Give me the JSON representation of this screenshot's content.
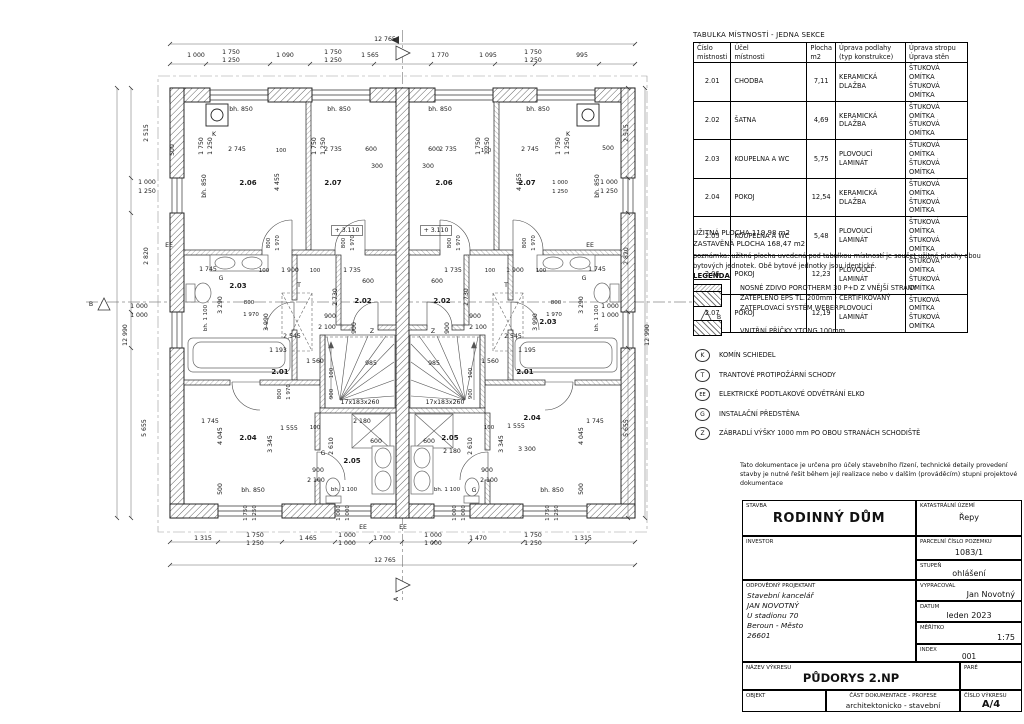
{
  "table": {
    "title": "TABULKA MÍSTNOSTÍ - JEDNA SEKCE",
    "headers": [
      "Číslo\nmístnosti",
      "Účel\nmístnosti",
      "Plocha\nm2",
      "Úprava podlahy\n(typ konstrukce)",
      "Úprava stropu\nÚprava stěn"
    ],
    "rows": [
      {
        "no": "2.01",
        "name": "CHODBA",
        "area": "7,11",
        "floor": "KERAMICKÁ DLAŽBA",
        "fin": "ŠTUKOVÁ OMÍTKA\nŠTUKOVÁ OMÍTKA"
      },
      {
        "no": "2.02",
        "name": "ŠATNA",
        "area": "4,69",
        "floor": "KERAMICKÁ DLAŽBA",
        "fin": "ŠTUKOVÁ OMÍTKA\nŠTUKOVÁ OMÍTKA"
      },
      {
        "no": "2.03",
        "name": "KOUPELNA A WC",
        "area": "5,75",
        "floor": "PLOVOUCÍ LAMINÁT",
        "fin": "ŠTUKOVÁ OMÍTKA\nŠTUKOVÁ OMÍTKA"
      },
      {
        "no": "2.04",
        "name": "POKOJ",
        "area": "12,54",
        "floor": "KERAMICKÁ DLAŽBA",
        "fin": "ŠTUKOVÁ OMÍTKA\nŠTUKOVÁ OMÍTKA"
      },
      {
        "no": "2.05",
        "name": "KOUPELNA A WC",
        "area": "5,48",
        "floor": "PLOVOUCÍ LAMINÁT",
        "fin": "ŠTUKOVÁ OMÍTKA\nŠTUKOVÁ OMÍTKA"
      },
      {
        "no": "2.06",
        "name": "POKOJ",
        "area": "12,23",
        "floor": "PLOVOUCÍ LAMINÁT",
        "fin": "ŠTUKOVÁ OMÍTKA\nŠTUKOVÁ OMÍTKA"
      },
      {
        "no": "2.07",
        "name": "POKOJ",
        "area": "12,19",
        "floor": "PLOVOUCÍ LAMINÁT",
        "fin": "ŠTUKOVÁ OMÍTKA\nŠTUKOVÁ OMÍTKA"
      }
    ]
  },
  "summary": {
    "usable": "UŽITNÁ PLOCHA 119,98 m2",
    "built": "ZASTAVĚNÁ PLOCHA 168,47 m2"
  },
  "note": "poznámka: užitná plocha uvedená pod tabulkou místností je součet užitné plochy obou bytových jednotek. Obě bytové jednotky jsou identické.",
  "legend": {
    "title": "LEGENDA",
    "wall1": "NOSNÉ ZDIVO POROTHERM 30 P+D Z VNĚJŠÍ STRANY\nZATEPLENO EPS TL. 200mm - CERTIFIKOVANÝ\nZATEPLOVACÍ SYSTÉM WEBER",
    "wall2": "VNITŘNÍ PŘÍČKY YTONG 100mm",
    "symbols": [
      {
        "key": "K",
        "text": "KOMÍN SCHIEDEL"
      },
      {
        "key": "T",
        "text": "TRANTOVÉ PROTIPOŽÁRNÍ SCHODY"
      },
      {
        "key": "EE",
        "text": "ELEKTRICKÉ PODTLAKOVÉ ODVĚTRÁNÍ ELKO"
      },
      {
        "key": "G",
        "text": "INSTALAČNÍ PŘEDSTĚNA"
      },
      {
        "key": "Z",
        "text": "ZÁBRADLÍ VÝŠKY 1000 mm PO OBOU STRANÁCH SCHODIŠTĚ"
      }
    ]
  },
  "titleblock": {
    "disclaimer": "Tato dokumentace je určena pro účely stavebního řízení, technické detaily provedení stavby je nutné řešit během její realizace nebo v dalším (prováděcím) stupni projektové dokumentace",
    "stavba_label": "STAVBA",
    "stavba": "RODINNÝ DŮM",
    "ku_label": "KATASTRÁLNÍ ÚZEMÍ",
    "ku": "Řepy",
    "investor_label": "INVESTOR",
    "investor": "",
    "parcela_label": "PARCELNÍ ČÍSLO POZEMKU",
    "parcela": "1083/1",
    "stupen_label": "STUPEŇ",
    "stupen": "ohlášení",
    "projektant_label": "ODPOVĚDNÝ PROJEKTANT",
    "projektant": "Stavební kancelář\nJAN NOVOTNÝ\nU stadionu 70\nBeroun - Město\n26601",
    "vypracoval_label": "VYPRACOVAL",
    "vypracoval": "Jan Novotný",
    "datum_label": "DATUM",
    "datum": "leden 2023",
    "meritko_label": "MĚŘÍTKO",
    "meritko": "1:75",
    "index_label": "INDEX",
    "index": "001",
    "nazev_label": "NÁZEV VÝKRESU",
    "nazev": "PŮDORYS 2.NP",
    "pare_label": "PARÉ",
    "objekt_label": "OBJEKT",
    "cast_label": "ČÁST DOKUMENTACE - PROFESE",
    "cast": "architektonicko - stavební",
    "cislo_label": "ČÍSLO VÝKRESU",
    "cislo": "A/4"
  },
  "plan": {
    "labels": [
      {
        "t": "12 765",
        "x": 385,
        "y": 41
      },
      {
        "t": "1 000",
        "x": 196,
        "y": 57
      },
      {
        "t": "1 750",
        "x": 231,
        "y": 54
      },
      {
        "t": "1 250",
        "x": 231,
        "y": 62
      },
      {
        "t": "1 090",
        "x": 285,
        "y": 57
      },
      {
        "t": "1 750",
        "x": 333,
        "y": 54
      },
      {
        "t": "1 250",
        "x": 333,
        "y": 62
      },
      {
        "t": "1 565",
        "x": 370,
        "y": 57
      },
      {
        "t": "1 770",
        "x": 440,
        "y": 57
      },
      {
        "t": "1 095",
        "x": 488,
        "y": 57
      },
      {
        "t": "1 750",
        "x": 533,
        "y": 54
      },
      {
        "t": "1 250",
        "x": 533,
        "y": 62
      },
      {
        "t": "995",
        "x": 582,
        "y": 57
      },
      {
        "t": "500",
        "x": 174,
        "y": 150,
        "r": 1
      },
      {
        "t": "1 750",
        "x": 203,
        "y": 146,
        "r": 1
      },
      {
        "t": "1 250",
        "x": 212,
        "y": 146,
        "r": 1
      },
      {
        "t": "1 750",
        "x": 316,
        "y": 146,
        "r": 1
      },
      {
        "t": "1 250",
        "x": 325,
        "y": 146,
        "r": 1
      },
      {
        "t": "1 750",
        "x": 480,
        "y": 146,
        "r": 1
      },
      {
        "t": "1 250",
        "x": 489,
        "y": 146,
        "r": 1
      },
      {
        "t": "1 750",
        "x": 560,
        "y": 146,
        "r": 1
      },
      {
        "t": "1 250",
        "x": 569,
        "y": 146,
        "r": 1
      },
      {
        "t": "500",
        "x": 608,
        "y": 150
      },
      {
        "t": "bh. 850",
        "x": 241,
        "y": 111
      },
      {
        "t": "bh. 850",
        "x": 339,
        "y": 111
      },
      {
        "t": "bh. 850",
        "x": 440,
        "y": 111
      },
      {
        "t": "bh. 850",
        "x": 538,
        "y": 111
      },
      {
        "t": "K",
        "x": 214,
        "y": 136
      },
      {
        "t": "K",
        "x": 568,
        "y": 136
      },
      {
        "t": "2 745",
        "x": 237,
        "y": 151
      },
      {
        "t": "100",
        "x": 281,
        "y": 152,
        "s": 5.5
      },
      {
        "t": "2 735",
        "x": 333,
        "y": 151
      },
      {
        "t": "600",
        "x": 371,
        "y": 151
      },
      {
        "t": "300",
        "x": 377,
        "y": 168
      },
      {
        "t": "2 735",
        "x": 448,
        "y": 151
      },
      {
        "t": "100",
        "x": 486,
        "y": 152,
        "s": 5.5
      },
      {
        "t": "2 745",
        "x": 530,
        "y": 151
      },
      {
        "t": "600",
        "x": 434,
        "y": 151
      },
      {
        "t": "300",
        "x": 428,
        "y": 168
      },
      {
        "t": "4 455",
        "x": 279,
        "y": 182,
        "r": 1
      },
      {
        "t": "4 455",
        "x": 521,
        "y": 182,
        "r": 1
      },
      {
        "t": "2.06",
        "x": 248,
        "y": 185,
        "w": 1
      },
      {
        "t": "2.07",
        "x": 333,
        "y": 185,
        "w": 1
      },
      {
        "t": "2.06",
        "x": 444,
        "y": 185,
        "w": 1
      },
      {
        "t": "2.07",
        "x": 527,
        "y": 185,
        "w": 1
      },
      {
        "t": "bh. 850",
        "x": 206,
        "y": 186,
        "r": 1
      },
      {
        "t": "bh. 850",
        "x": 599,
        "y": 186,
        "r": 1
      },
      {
        "t": "+ 3.110",
        "x": 347,
        "y": 232,
        "box": 1
      },
      {
        "t": "+ 3.110",
        "x": 436,
        "y": 232,
        "box": 1
      },
      {
        "t": "800",
        "x": 270,
        "y": 243,
        "r": 1,
        "s": 5.5
      },
      {
        "t": "1 970",
        "x": 279,
        "y": 243,
        "r": 1,
        "s": 5.5
      },
      {
        "t": "800",
        "x": 345,
        "y": 243,
        "r": 1,
        "s": 5.5
      },
      {
        "t": "1 970",
        "x": 354,
        "y": 243,
        "r": 1,
        "s": 5.5
      },
      {
        "t": "800",
        "x": 451,
        "y": 243,
        "r": 1,
        "s": 5.5
      },
      {
        "t": "1 970",
        "x": 460,
        "y": 243,
        "r": 1,
        "s": 5.5
      },
      {
        "t": "800",
        "x": 526,
        "y": 243,
        "r": 1,
        "s": 5.5
      },
      {
        "t": "1 970",
        "x": 535,
        "y": 243,
        "r": 1,
        "s": 5.5
      },
      {
        "t": "2 515",
        "x": 148,
        "y": 133,
        "r": 1
      },
      {
        "t": "2 515",
        "x": 628,
        "y": 133,
        "r": 1
      },
      {
        "t": "1 000",
        "x": 147,
        "y": 184
      },
      {
        "t": "1 250",
        "x": 147,
        "y": 193
      },
      {
        "t": "1 000",
        "x": 609,
        "y": 184
      },
      {
        "t": "1 250",
        "x": 609,
        "y": 193
      },
      {
        "t": "1 000",
        "x": 560,
        "y": 184,
        "s": 5.5
      },
      {
        "t": "1 250",
        "x": 560,
        "y": 193,
        "s": 5.5
      },
      {
        "t": "2 820",
        "x": 148,
        "y": 256,
        "r": 1
      },
      {
        "t": "2 820",
        "x": 628,
        "y": 256,
        "r": 1
      },
      {
        "t": "EE",
        "x": 169,
        "y": 247
      },
      {
        "t": "EE",
        "x": 590,
        "y": 247
      },
      {
        "t": "12 990",
        "x": 127,
        "y": 335,
        "r": 1
      },
      {
        "t": "12 990",
        "x": 649,
        "y": 335,
        "r": 1
      },
      {
        "t": "1 745",
        "x": 208,
        "y": 271
      },
      {
        "t": "100",
        "x": 264,
        "y": 272,
        "s": 5.5
      },
      {
        "t": "1 900",
        "x": 290,
        "y": 272
      },
      {
        "t": "100",
        "x": 315,
        "y": 272,
        "s": 5.5
      },
      {
        "t": "1 735",
        "x": 352,
        "y": 272
      },
      {
        "t": "600",
        "x": 368,
        "y": 283
      },
      {
        "t": "G",
        "x": 221,
        "y": 280
      },
      {
        "t": "T",
        "x": 299,
        "y": 287
      },
      {
        "t": "2.03",
        "x": 238,
        "y": 288,
        "w": 1
      },
      {
        "t": "2.02",
        "x": 363,
        "y": 303,
        "w": 1
      },
      {
        "t": "2 730",
        "x": 337,
        "y": 297,
        "r": 1
      },
      {
        "t": "3 290",
        "x": 222,
        "y": 305,
        "r": 1
      },
      {
        "t": "bh. 1 100",
        "x": 207,
        "y": 318,
        "r": 1,
        "s": 5.5
      },
      {
        "t": "800",
        "x": 249,
        "y": 304,
        "s": 5.5
      },
      {
        "t": "1 970",
        "x": 251,
        "y": 316,
        "s": 5.5
      },
      {
        "t": "3 990",
        "x": 268,
        "y": 322,
        "r": 1
      },
      {
        "t": "900",
        "x": 330,
        "y": 318
      },
      {
        "t": "2 100",
        "x": 327,
        "y": 329
      },
      {
        "t": "900",
        "x": 356,
        "y": 328,
        "r": 1
      },
      {
        "t": "2 545",
        "x": 292,
        "y": 338
      },
      {
        "t": "Z",
        "x": 372,
        "y": 333
      },
      {
        "t": "1 193",
        "x": 278,
        "y": 352
      },
      {
        "t": "1 560",
        "x": 315,
        "y": 363
      },
      {
        "t": "985",
        "x": 371,
        "y": 365
      },
      {
        "t": "100",
        "x": 333,
        "y": 373,
        "r": 1,
        "s": 5.5
      },
      {
        "t": "2.01",
        "x": 280,
        "y": 374,
        "w": 1
      },
      {
        "t": "800",
        "x": 281,
        "y": 394,
        "r": 1,
        "s": 5.5
      },
      {
        "t": "1 970",
        "x": 290,
        "y": 392,
        "r": 1,
        "s": 5.5
      },
      {
        "t": "900",
        "x": 333,
        "y": 394,
        "r": 1,
        "s": 5.5
      },
      {
        "t": "17x183x260",
        "x": 360,
        "y": 404
      },
      {
        "t": "1 745",
        "x": 597,
        "y": 271
      },
      {
        "t": "100",
        "x": 541,
        "y": 272,
        "s": 5.5
      },
      {
        "t": "1 900",
        "x": 515,
        "y": 272
      },
      {
        "t": "100",
        "x": 490,
        "y": 272,
        "s": 5.5
      },
      {
        "t": "1 735",
        "x": 453,
        "y": 272
      },
      {
        "t": "600",
        "x": 437,
        "y": 283
      },
      {
        "t": "G",
        "x": 584,
        "y": 280
      },
      {
        "t": "T",
        "x": 506,
        "y": 287
      },
      {
        "t": "2.03",
        "x": 548,
        "y": 324,
        "w": 1
      },
      {
        "t": "2.02",
        "x": 442,
        "y": 303,
        "w": 1
      },
      {
        "t": "2 730",
        "x": 468,
        "y": 297,
        "r": 1
      },
      {
        "t": "3 290",
        "x": 583,
        "y": 305,
        "r": 1
      },
      {
        "t": "bh. 1 100",
        "x": 598,
        "y": 318,
        "r": 1,
        "s": 5.5
      },
      {
        "t": "800",
        "x": 556,
        "y": 304,
        "s": 5.5
      },
      {
        "t": "1 970",
        "x": 554,
        "y": 316,
        "s": 5.5
      },
      {
        "t": "3 990",
        "x": 537,
        "y": 322,
        "r": 1
      },
      {
        "t": "900",
        "x": 475,
        "y": 318
      },
      {
        "t": "2 100",
        "x": 478,
        "y": 329
      },
      {
        "t": "900",
        "x": 449,
        "y": 328,
        "r": 1
      },
      {
        "t": "2 545",
        "x": 513,
        "y": 338
      },
      {
        "t": "Z",
        "x": 433,
        "y": 333
      },
      {
        "t": "1 195",
        "x": 527,
        "y": 352
      },
      {
        "t": "1 560",
        "x": 490,
        "y": 363
      },
      {
        "t": "985",
        "x": 434,
        "y": 365
      },
      {
        "t": "100",
        "x": 472,
        "y": 373,
        "r": 1,
        "s": 5.5
      },
      {
        "t": "2.01",
        "x": 525,
        "y": 374,
        "w": 1
      },
      {
        "t": "900",
        "x": 472,
        "y": 394,
        "r": 1,
        "s": 5.5
      },
      {
        "t": "17x183x260",
        "x": 445,
        "y": 404
      },
      {
        "t": "1 745",
        "x": 210,
        "y": 423
      },
      {
        "t": "4 045",
        "x": 222,
        "y": 436,
        "r": 1
      },
      {
        "t": "2.04",
        "x": 248,
        "y": 440,
        "w": 1
      },
      {
        "t": "3 345",
        "x": 272,
        "y": 444,
        "r": 1
      },
      {
        "t": "1 555",
        "x": 289,
        "y": 430
      },
      {
        "t": "100",
        "x": 315,
        "y": 429,
        "s": 5.5
      },
      {
        "t": "2 610",
        "x": 333,
        "y": 446,
        "r": 1
      },
      {
        "t": "2 180",
        "x": 362,
        "y": 423
      },
      {
        "t": "600",
        "x": 376,
        "y": 443
      },
      {
        "t": "G",
        "x": 323,
        "y": 455
      },
      {
        "t": "2.05",
        "x": 352,
        "y": 463,
        "w": 1
      },
      {
        "t": "900",
        "x": 318,
        "y": 472
      },
      {
        "t": "2 100",
        "x": 316,
        "y": 482
      },
      {
        "t": "bh. 850",
        "x": 253,
        "y": 492
      },
      {
        "t": "bh. 1 100",
        "x": 344,
        "y": 491,
        "s": 5.5
      },
      {
        "t": "500",
        "x": 222,
        "y": 489,
        "r": 1
      },
      {
        "t": "1 745",
        "x": 595,
        "y": 423
      },
      {
        "t": "4 045",
        "x": 583,
        "y": 436,
        "r": 1
      },
      {
        "t": "2.04",
        "x": 532,
        "y": 420,
        "w": 1
      },
      {
        "t": "3 345",
        "x": 503,
        "y": 444,
        "r": 1
      },
      {
        "t": "1 555",
        "x": 516,
        "y": 428
      },
      {
        "t": "100",
        "x": 489,
        "y": 429,
        "s": 5.5
      },
      {
        "t": "2 610",
        "x": 472,
        "y": 446,
        "r": 1
      },
      {
        "t": "2 180",
        "x": 452,
        "y": 453
      },
      {
        "t": "600",
        "x": 429,
        "y": 443
      },
      {
        "t": "3 300",
        "x": 527,
        "y": 451
      },
      {
        "t": "G",
        "x": 474,
        "y": 492
      },
      {
        "t": "2.05",
        "x": 450,
        "y": 440,
        "w": 1
      },
      {
        "t": "900",
        "x": 487,
        "y": 472
      },
      {
        "t": "2 100",
        "x": 489,
        "y": 482
      },
      {
        "t": "bh. 850",
        "x": 552,
        "y": 492
      },
      {
        "t": "bh. 1 100",
        "x": 447,
        "y": 491,
        "s": 5.5
      },
      {
        "t": "500",
        "x": 583,
        "y": 489,
        "r": 1
      },
      {
        "t": "1 000",
        "x": 139,
        "y": 308
      },
      {
        "t": "1 000",
        "x": 139,
        "y": 317
      },
      {
        "t": "1 000",
        "x": 610,
        "y": 308
      },
      {
        "t": "1 000",
        "x": 610,
        "y": 317
      },
      {
        "t": "5 655",
        "x": 146,
        "y": 428,
        "r": 1
      },
      {
        "t": "5 655",
        "x": 628,
        "y": 428,
        "r": 1
      },
      {
        "t": "1 750",
        "x": 247,
        "y": 513,
        "r": 1,
        "s": 5.5
      },
      {
        "t": "1 250",
        "x": 256,
        "y": 513,
        "r": 1,
        "s": 5.5
      },
      {
        "t": "1 000",
        "x": 340,
        "y": 513,
        "r": 1,
        "s": 5.5
      },
      {
        "t": "1 000",
        "x": 349,
        "y": 513,
        "r": 1,
        "s": 5.5
      },
      {
        "t": "1 000",
        "x": 456,
        "y": 513,
        "r": 1,
        "s": 5.5
      },
      {
        "t": "1 000",
        "x": 465,
        "y": 513,
        "r": 1,
        "s": 5.5
      },
      {
        "t": "1 750",
        "x": 549,
        "y": 513,
        "r": 1,
        "s": 5.5
      },
      {
        "t": "1 250",
        "x": 558,
        "y": 513,
        "r": 1,
        "s": 5.5
      },
      {
        "t": "EE",
        "x": 363,
        "y": 529
      },
      {
        "t": "EE",
        "x": 403,
        "y": 529
      },
      {
        "t": "1 315",
        "x": 203,
        "y": 540
      },
      {
        "t": "1 750",
        "x": 255,
        "y": 537
      },
      {
        "t": "1 250",
        "x": 255,
        "y": 545
      },
      {
        "t": "1 465",
        "x": 308,
        "y": 540
      },
      {
        "t": "1 000",
        "x": 347,
        "y": 537
      },
      {
        "t": "1 000",
        "x": 347,
        "y": 545
      },
      {
        "t": "1 700",
        "x": 382,
        "y": 540
      },
      {
        "t": "1 000",
        "x": 433,
        "y": 537
      },
      {
        "t": "1 000",
        "x": 433,
        "y": 545
      },
      {
        "t": "1 470",
        "x": 478,
        "y": 540
      },
      {
        "t": "1 750",
        "x": 533,
        "y": 537
      },
      {
        "t": "1 250",
        "x": 533,
        "y": 545
      },
      {
        "t": "1 315",
        "x": 583,
        "y": 540
      },
      {
        "t": "12 765",
        "x": 385,
        "y": 562
      },
      {
        "t": "A",
        "x": 398,
        "y": 599,
        "r": 1
      },
      {
        "t": "B",
        "x": 91,
        "y": 306
      },
      {
        "t": "B",
        "x": 719,
        "y": 319
      }
    ]
  }
}
